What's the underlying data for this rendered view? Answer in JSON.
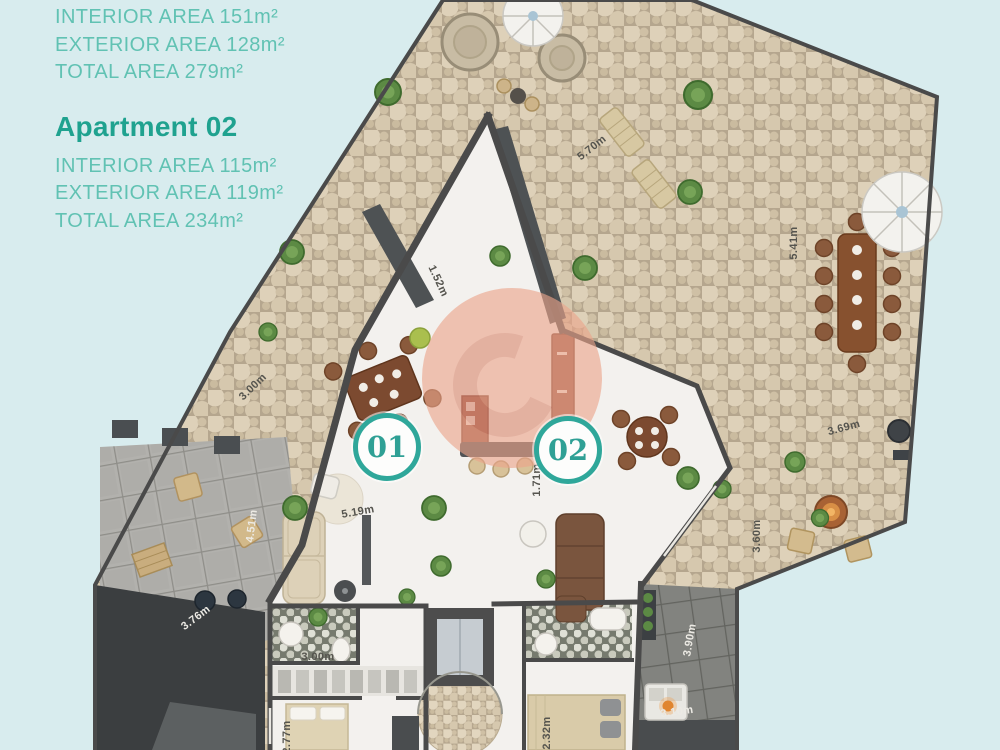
{
  "legend": {
    "apartment_01": {
      "interior": "INTERIOR AREA 151m²",
      "exterior": "EXTERIOR AREA 128m²",
      "total": "TOTAL AREA 279m²"
    },
    "apartment_02": {
      "title": "Apartment 02",
      "interior": "INTERIOR AREA 115m²",
      "exterior": "EXTERIOR AREA 119m²",
      "total": "TOTAL AREA 234m²"
    }
  },
  "plan": {
    "units": [
      {
        "label": "01"
      },
      {
        "label": "02"
      }
    ],
    "dimensions": [
      {
        "text": "5.70m"
      },
      {
        "text": "1.52m"
      },
      {
        "text": "3.00m"
      },
      {
        "text": "5.41m"
      },
      {
        "text": "3.69m"
      },
      {
        "text": "3.60m"
      },
      {
        "text": "4.51m"
      },
      {
        "text": "3.76m"
      },
      {
        "text": "5.19m"
      },
      {
        "text": "3.00m"
      },
      {
        "text": "2.77m"
      },
      {
        "text": "1.71m"
      },
      {
        "text": "2.32m"
      },
      {
        "text": "3.90m"
      },
      {
        "text": "3.10m"
      }
    ],
    "colors": {
      "background": "#d8ecee",
      "teal_text": "#61c2b3",
      "teal_heading": "#1fa28f",
      "unit_ring": "#2fa79a",
      "watermark": "#eca58b",
      "wall": "#4a4a4a",
      "stone": "#ded1b9"
    }
  }
}
